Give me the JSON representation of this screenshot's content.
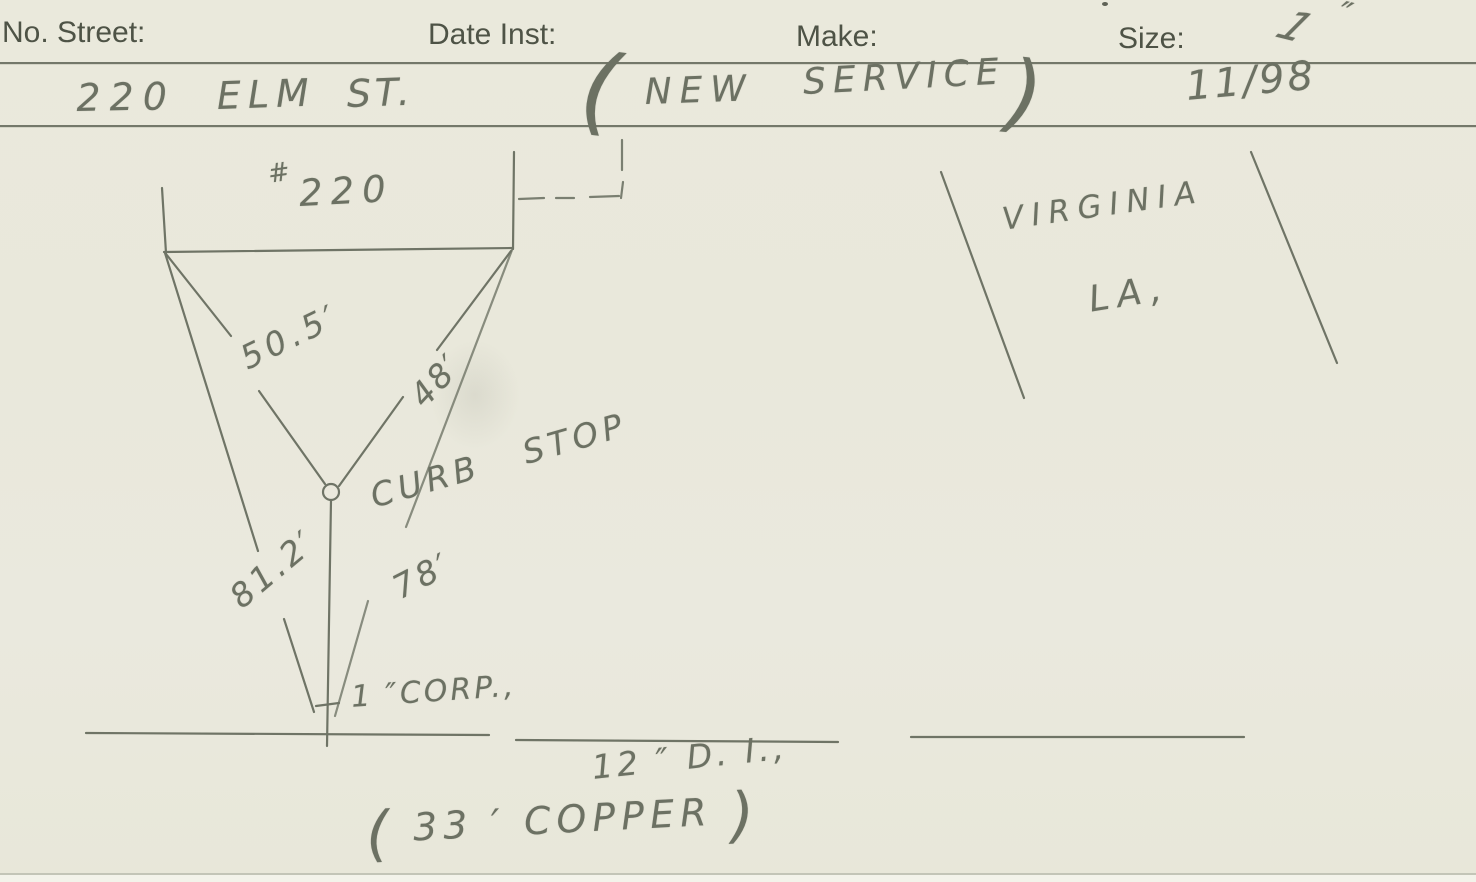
{
  "header": {
    "fields": [
      {
        "label": "No. Street:"
      },
      {
        "label": "Date Inst:"
      },
      {
        "label": "Make:"
      },
      {
        "label": "Size:"
      }
    ],
    "size_value": "1",
    "size_unit_mark": "″"
  },
  "address": {
    "number": "220",
    "street": "ELM",
    "abbr": "ST.",
    "paren_open": "(",
    "word_new": "NEW",
    "word_service": "SERVICE",
    "paren_close": ")",
    "date_installed": "11/98"
  },
  "sketch": {
    "house_hash": "#",
    "house_number": "220",
    "dim_left_to_curb": "50.5′",
    "dim_right_to_curb": "48′",
    "dim_left_to_main": "81.2′",
    "dim_right_to_main": "78′",
    "curb_stop_label": "CURB STOP",
    "corp_label": "1 ″CORP.,",
    "main_label": "12 ″ D. I.,",
    "copper_open": "(",
    "copper_note": "33 ′ COPPER",
    "copper_close": ")",
    "location_line1": "VIRGINIA",
    "location_line2": "LA,"
  },
  "colors": {
    "paper": "#e9e8db",
    "pencil": "#6c7163",
    "printed_ink": "#4e5346",
    "rule_line": "#565b4d"
  }
}
